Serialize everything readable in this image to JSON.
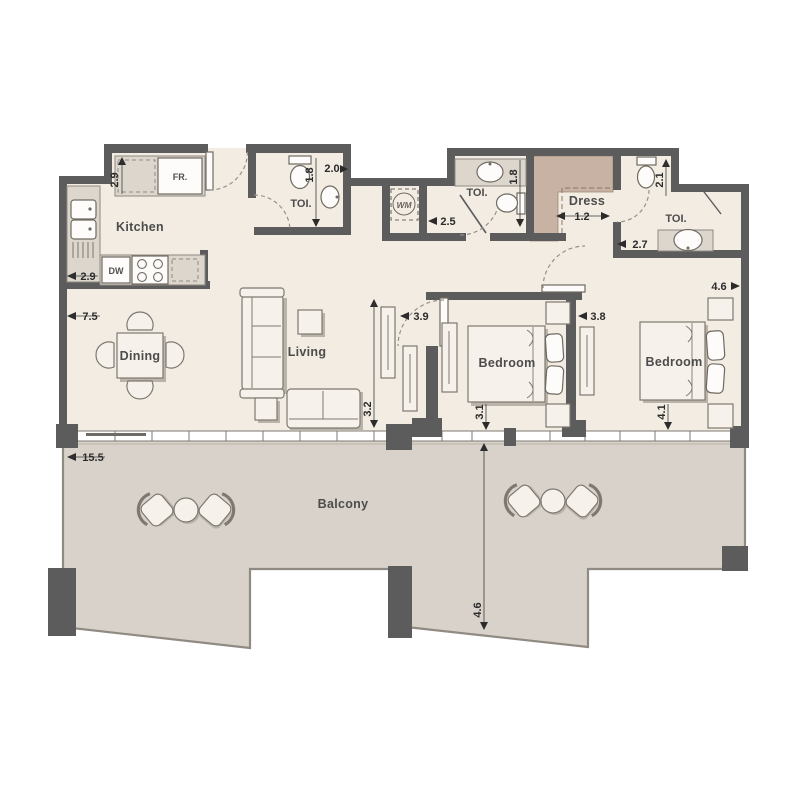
{
  "plan": {
    "rooms": {
      "kitchen": "Kitchen",
      "dining": "Dining",
      "living": "Living",
      "bedroom1": "Bedroom",
      "bedroom2": "Bedroom",
      "dress": "Dress",
      "toilet1": "TOI.",
      "toilet2": "TOI.",
      "toilet3": "TOI.",
      "balcony": "Balcony"
    },
    "appliances": {
      "fridge": "FR.",
      "dishwasher": "DW",
      "washer": "WM"
    },
    "dims": {
      "kitchen_left": "2.9",
      "kitchen_bottom": "2.9",
      "toilet1_w": "2.0",
      "toilet1_h": "1.8",
      "lobby": "2.5",
      "toilet2_h": "1.8",
      "dress_w": "1.2",
      "toilet3_h": "2.1",
      "toilet3_w": "2.7",
      "bedroom2_top": "4.6",
      "living_w": "7.5",
      "hall_w": "3.9",
      "living_h": "3.2",
      "bedroom1_w": "3.8",
      "bedroom1_h": "3.1",
      "bedroom2_h": "4.1",
      "balcony_w": "15.5",
      "balcony_d": "4.6"
    },
    "colors": {
      "floor": "#f2ece3",
      "balcony_floor": "#d9d2ca",
      "wall": "#5c5c5c",
      "wardrobe": "#c8b2a3"
    }
  }
}
